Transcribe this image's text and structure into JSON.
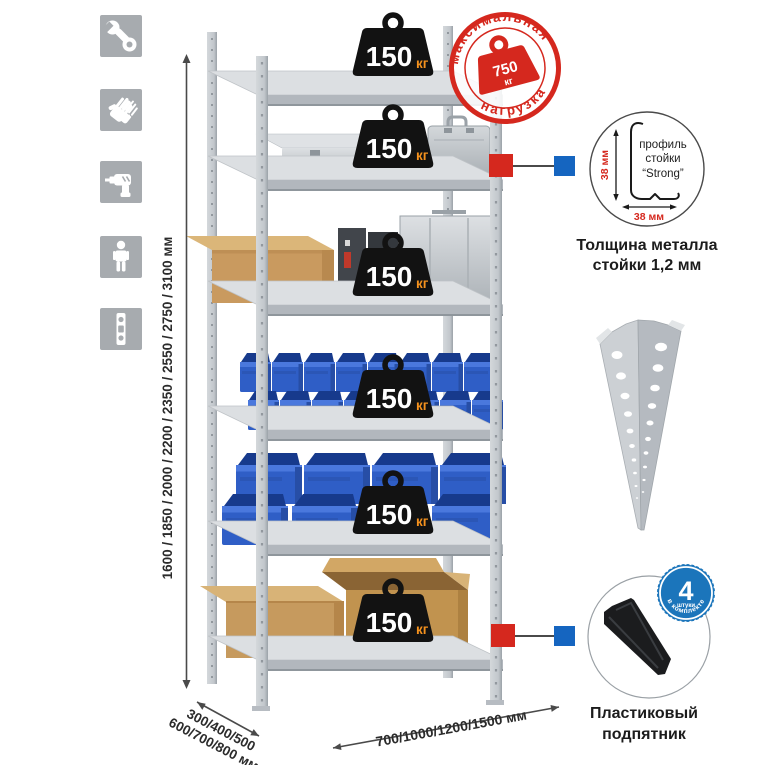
{
  "left_icons": {
    "items": [
      {
        "icon": "wrench-icon"
      },
      {
        "icon": "gloves-icon"
      },
      {
        "icon": "drill-icon"
      },
      {
        "icon": "person-icon"
      },
      {
        "icon": "level-icon"
      }
    ]
  },
  "height_dimension": {
    "label": "1600 / 1850 / 2000 / 2200 / 2350 / 2550 / 2750 / 3100 мм"
  },
  "depth_dimension": {
    "line1": "300/400/500",
    "line2": "600/700/800 мм"
  },
  "width_dimension": {
    "label": "700/1000/1200/1500 мм"
  },
  "shelf_load": {
    "value": "150",
    "unit": "кг"
  },
  "max_load_stamp": {
    "top_text": "максимальная",
    "bottom_text": "нагрузка",
    "value": "750",
    "unit": "кг"
  },
  "profile_detail": {
    "label_line1": "профиль",
    "label_line2": "стойки",
    "label_line3": "“Strong”",
    "vertical_dim": "38 мм",
    "horizontal_dim": "38 мм"
  },
  "profile_caption": {
    "line1": "Толщина металла",
    "line2": "стойки 1,2 мм"
  },
  "foot_badge": {
    "value": "4",
    "small_text": "штуки",
    "arc_text": "в комплекте"
  },
  "foot_caption": {
    "line1": "Пластиковый",
    "line2": "подпятник"
  },
  "colors": {
    "accent_red": "#d5281e",
    "marker_blue": "#1565c0",
    "badge_blue": "#1b75bb",
    "weight_black": "#121212",
    "unit_orange": "#f5921e",
    "bin_blue": "#2f5ec6",
    "cardboard": "#c69a5e",
    "metal_light": "#dcdfe2",
    "icon_gray": "#a7abaf"
  }
}
